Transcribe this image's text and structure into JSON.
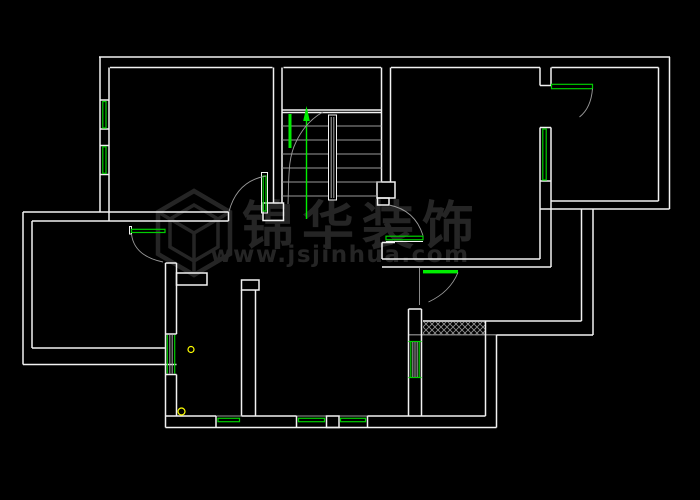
{
  "watermark": {
    "logo": "jinhua-hexagon-logo",
    "company_text": "锦华装饰",
    "url_text": "www.jsjinhua.com"
  },
  "colors": {
    "background": "#000000",
    "wall-line": "#f2f2f2",
    "green-line": "#00cf00",
    "green-fill": "#00ee00",
    "stair-gray": "#9a9a9a",
    "watermark-gray": "#282828",
    "drain-yellow": "#ffff00",
    "hatch-gray": "#8f8f8f"
  }
}
